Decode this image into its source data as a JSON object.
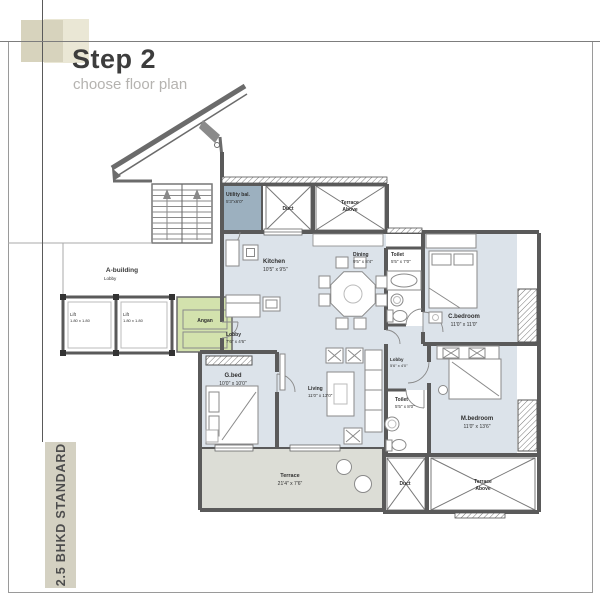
{
  "header": {
    "step": "Step 2",
    "subtitle": "choose floor plan"
  },
  "sidebar": {
    "label": "2.5 BHKD STANDARD"
  },
  "building": {
    "label": "A-building",
    "sublabel": "Lobby"
  },
  "rooms": {
    "utility_bal": {
      "name": "Utility bal.",
      "dims": "5'3\"x6'0\""
    },
    "duct_top": {
      "name": "Duct"
    },
    "terrace_above_top": {
      "line1": "Terrace",
      "line2": "Above"
    },
    "kitchen": {
      "name": "Kitchen",
      "dims": "10'5\" x 9'5\""
    },
    "dining": {
      "name": "Dining",
      "dims": "9'5\" x 8'4\""
    },
    "toilet_top": {
      "name": "Toilet",
      "dims": "5'5\" x 7'0\""
    },
    "c_bedroom": {
      "name": "C.bedroom",
      "dims": "11'0\" x 11'0\""
    },
    "lobby_entrance": {
      "name": "Lobby",
      "dims": "7'6\" x 4'6\""
    },
    "g_bed": {
      "name": "G.bed",
      "dims": "10'0\" x 10'0\""
    },
    "living": {
      "name": "Living",
      "dims": "11'0\" x 13'0\""
    },
    "lobby_passage": {
      "name": "Lobby",
      "dims": "5'6\" x 4'0\""
    },
    "toilet_bottom": {
      "name": "Toilet",
      "dims": "5'5\" x 8'0\""
    },
    "m_bedroom": {
      "name": "M.bedroom",
      "dims": "11'0\" x 13'6\""
    },
    "terrace_main": {
      "name": "Terrace",
      "dims": "21'4\" x 7'6\""
    },
    "duct_bottom": {
      "name": "Duct"
    },
    "terrace_above_bottom": {
      "line1": "Terrace",
      "line2": "Above"
    },
    "angan": {
      "name": "Angan"
    },
    "lift1": {
      "name": "Lift",
      "dims": "1.80 x 1.80"
    },
    "lift2": {
      "name": "Lift",
      "dims": "1.80 x 1.80"
    }
  },
  "colors": {
    "room_fill": "#dce3ea",
    "utility_fill": "#9cb0bf",
    "angan_fill": "#d3e2ad",
    "terrace_fill": "#dcddd6",
    "wall": "#5a5a5a",
    "accent_bar": "#d4d1c2"
  }
}
